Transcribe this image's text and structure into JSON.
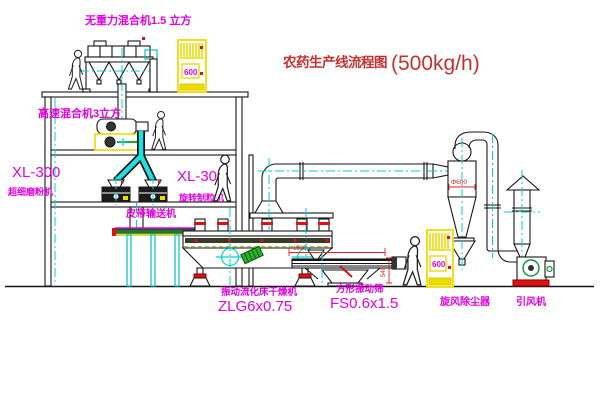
{
  "title": {
    "name_cn": "农药生产线流程图",
    "capacity": "(500kg/h)"
  },
  "labels": {
    "gravity_mixer": "无重力混合机1.5 立方",
    "high_speed_mixer": "高速混合机3立方",
    "mill_model": "XL-300",
    "mill_name": "超细磨粉机",
    "granulator_model": "XL-300",
    "granulator_name": "旋转制粒机",
    "belt_conveyor": "皮带输送机",
    "dryer_name": "振动流化床干燥机",
    "dryer_model": "ZLG6x0.75",
    "sieve_name": "方形振动筛",
    "sieve_model": "FS0.6x1.5",
    "cyclone": "旋风除尘器",
    "fan": "引风机",
    "cabinet_top": "600",
    "cabinet_bottom": "600"
  },
  "dimensions": {
    "cyclone_diameter": "Φ600",
    "sieve_length": "1500",
    "sieve_height": "540"
  },
  "colors": {
    "label_magenta": "#e100e1",
    "title_red": "#c43131",
    "centerline_cyan": "#00d2d2",
    "cabinet_yellow": "#ecdc00",
    "machine_green": "#22aa22",
    "alert_red": "#dd1111"
  }
}
